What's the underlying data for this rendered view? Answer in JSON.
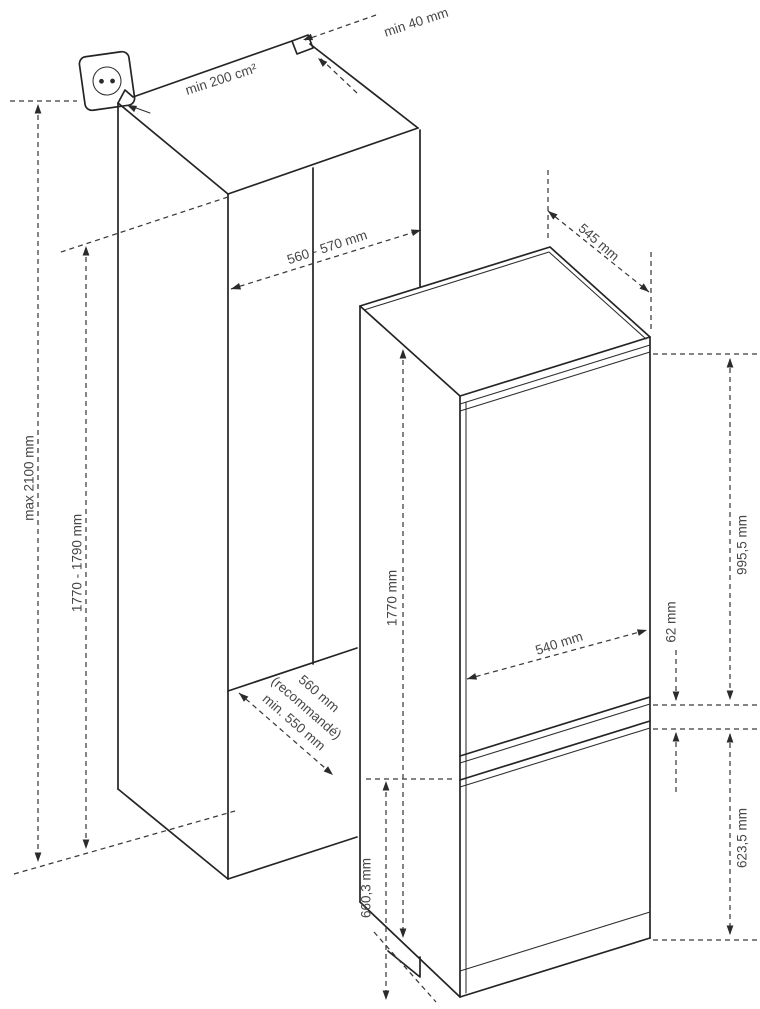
{
  "diagram": {
    "type": "appliance-installation-drawing",
    "description": "Built-in fridge-freezer: cabinet niche and appliance dimensions",
    "colors": {
      "line": "#242424",
      "dimension_line": "#3a3a3a",
      "text": "#474747",
      "background": "#ffffff"
    },
    "labels": {
      "vent_gap_top": "min 40 mm",
      "vent_area": "min 200 cm²",
      "niche_width": "560 - 570 mm",
      "max_overall_height": "max 2100 mm",
      "niche_height": "1770 - 1790 mm",
      "appliance_depth": "545 mm",
      "appliance_height": "1770 mm",
      "door_width": "540 mm",
      "door_gap": "62 mm",
      "upper_door_height": "995,5 mm",
      "lower_door_height": "623,5 mm",
      "freezer_section_height": "660,3 mm",
      "niche_depth_value": "560 mm",
      "niche_depth_note": "(recommandé)",
      "niche_depth_min": "min. 550 mm"
    },
    "icons": {
      "power_socket": "wall-socket"
    }
  }
}
